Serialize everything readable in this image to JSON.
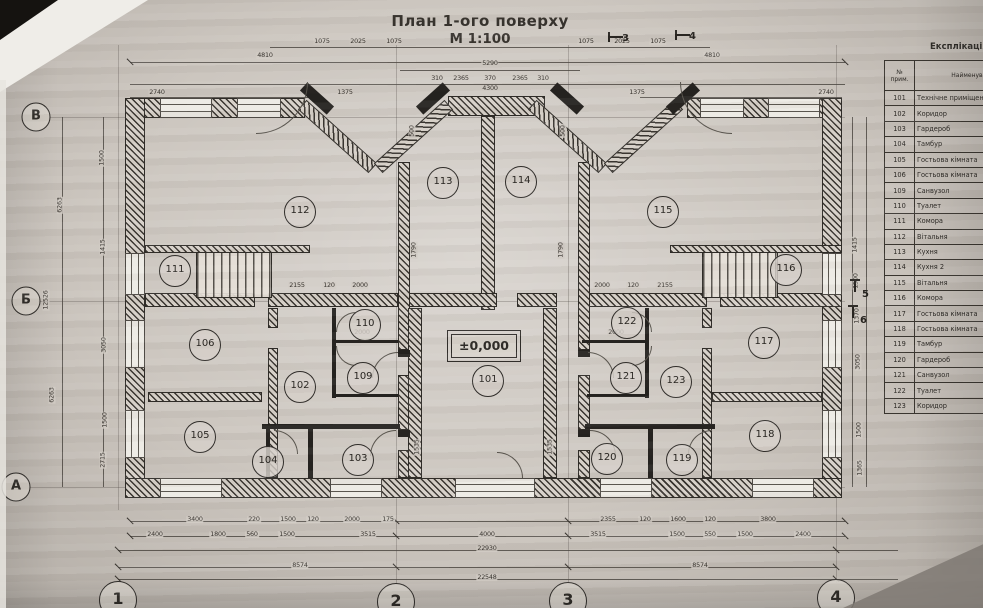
{
  "title": {
    "main": "План 1-ого поверху",
    "scale": "М 1:100"
  },
  "plan": {
    "elevation_mark": "±0,000",
    "axes": {
      "rows": [
        {
          "label": "В",
          "x": 36,
          "y": 117
        },
        {
          "label": "Б",
          "x": 26,
          "y": 301
        },
        {
          "label": "А",
          "x": 16,
          "y": 487
        }
      ],
      "cols": [
        {
          "label": "1",
          "x": 118,
          "y": 600
        },
        {
          "label": "2",
          "x": 396,
          "y": 602
        },
        {
          "label": "3",
          "x": 568,
          "y": 601
        },
        {
          "label": "4",
          "x": 836,
          "y": 598
        }
      ]
    },
    "section_marks": [
      {
        "label": "3",
        "x": 622,
        "y": 33,
        "o": "h"
      },
      {
        "label": "4",
        "x": 689,
        "y": 31,
        "o": "h"
      },
      {
        "label": "5",
        "x": 862,
        "y": 289,
        "o": "v"
      },
      {
        "label": "6",
        "x": 860,
        "y": 315,
        "o": "v"
      }
    ],
    "rooms": [
      {
        "num": "101",
        "x": 488,
        "y": 381
      },
      {
        "num": "102",
        "x": 300,
        "y": 387
      },
      {
        "num": "103",
        "x": 358,
        "y": 460
      },
      {
        "num": "104",
        "x": 268,
        "y": 462
      },
      {
        "num": "105",
        "x": 200,
        "y": 437
      },
      {
        "num": "106",
        "x": 205,
        "y": 345
      },
      {
        "num": "109",
        "x": 363,
        "y": 378
      },
      {
        "num": "110",
        "x": 365,
        "y": 325
      },
      {
        "num": "111",
        "x": 175,
        "y": 271
      },
      {
        "num": "112",
        "x": 300,
        "y": 212
      },
      {
        "num": "113",
        "x": 443,
        "y": 183
      },
      {
        "num": "114",
        "x": 521,
        "y": 182
      },
      {
        "num": "115",
        "x": 663,
        "y": 212
      },
      {
        "num": "116",
        "x": 786,
        "y": 270
      },
      {
        "num": "117",
        "x": 764,
        "y": 343
      },
      {
        "num": "118",
        "x": 765,
        "y": 436
      },
      {
        "num": "119",
        "x": 682,
        "y": 460
      },
      {
        "num": "120",
        "x": 607,
        "y": 459
      },
      {
        "num": "121",
        "x": 626,
        "y": 378
      },
      {
        "num": "122",
        "x": 627,
        "y": 323
      },
      {
        "num": "123",
        "x": 676,
        "y": 382
      }
    ],
    "dimensions": [
      {
        "t": "4810",
        "x": 265,
        "y": 56
      },
      {
        "t": "4810",
        "x": 712,
        "y": 56
      },
      {
        "t": "1075",
        "x": 322,
        "y": 42
      },
      {
        "t": "2025",
        "x": 358,
        "y": 42
      },
      {
        "t": "1075",
        "x": 394,
        "y": 42
      },
      {
        "t": "1075",
        "x": 586,
        "y": 42
      },
      {
        "t": "2025",
        "x": 622,
        "y": 42
      },
      {
        "t": "1075",
        "x": 658,
        "y": 42
      },
      {
        "t": "5290",
        "x": 490,
        "y": 64
      },
      {
        "t": "310",
        "x": 437,
        "y": 79
      },
      {
        "t": "2365",
        "x": 461,
        "y": 79
      },
      {
        "t": "370",
        "x": 490,
        "y": 79
      },
      {
        "t": "2365",
        "x": 520,
        "y": 79
      },
      {
        "t": "310",
        "x": 543,
        "y": 79
      },
      {
        "t": "4300",
        "x": 490,
        "y": 89
      },
      {
        "t": "2740",
        "x": 157,
        "y": 93
      },
      {
        "t": "1375",
        "x": 345,
        "y": 93
      },
      {
        "t": "1375",
        "x": 637,
        "y": 93
      },
      {
        "t": "2740",
        "x": 826,
        "y": 93
      },
      {
        "t": "3400",
        "x": 195,
        "y": 520
      },
      {
        "t": "220",
        "x": 254,
        "y": 520
      },
      {
        "t": "1500",
        "x": 288,
        "y": 520
      },
      {
        "t": "120",
        "x": 313,
        "y": 520
      },
      {
        "t": "2000",
        "x": 352,
        "y": 520
      },
      {
        "t": "175",
        "x": 388,
        "y": 520
      },
      {
        "t": "2355",
        "x": 608,
        "y": 520
      },
      {
        "t": "120",
        "x": 645,
        "y": 520
      },
      {
        "t": "1600",
        "x": 678,
        "y": 520
      },
      {
        "t": "120",
        "x": 710,
        "y": 520
      },
      {
        "t": "3800",
        "x": 768,
        "y": 520
      },
      {
        "t": "2400",
        "x": 155,
        "y": 535
      },
      {
        "t": "1800",
        "x": 218,
        "y": 535
      },
      {
        "t": "560",
        "x": 252,
        "y": 535
      },
      {
        "t": "1500",
        "x": 287,
        "y": 535
      },
      {
        "t": "3515",
        "x": 368,
        "y": 535
      },
      {
        "t": "4000",
        "x": 487,
        "y": 535
      },
      {
        "t": "3515",
        "x": 598,
        "y": 535
      },
      {
        "t": "1500",
        "x": 677,
        "y": 535
      },
      {
        "t": "550",
        "x": 710,
        "y": 535
      },
      {
        "t": "1500",
        "x": 745,
        "y": 535
      },
      {
        "t": "2400",
        "x": 803,
        "y": 535
      },
      {
        "t": "22930",
        "x": 487,
        "y": 549
      },
      {
        "t": "8574",
        "x": 300,
        "y": 566
      },
      {
        "t": "8574",
        "x": 700,
        "y": 566
      },
      {
        "t": "22548",
        "x": 487,
        "y": 578
      },
      {
        "t": "6263",
        "x": 60,
        "y": 205,
        "r": true
      },
      {
        "t": "12526",
        "x": 46,
        "y": 300,
        "r": true
      },
      {
        "t": "6263",
        "x": 52,
        "y": 395,
        "r": true
      },
      {
        "t": "1500",
        "x": 102,
        "y": 158,
        "r": true
      },
      {
        "t": "1415",
        "x": 103,
        "y": 247,
        "r": true
      },
      {
        "t": "3050",
        "x": 104,
        "y": 345,
        "r": true
      },
      {
        "t": "1500",
        "x": 105,
        "y": 420,
        "r": true
      },
      {
        "t": "2715",
        "x": 103,
        "y": 460,
        "r": true
      },
      {
        "t": "1415",
        "x": 855,
        "y": 245,
        "r": true
      },
      {
        "t": "1500",
        "x": 856,
        "y": 281,
        "r": true
      },
      {
        "t": "1370",
        "x": 857,
        "y": 316,
        "r": true
      },
      {
        "t": "3050",
        "x": 858,
        "y": 362,
        "r": true
      },
      {
        "t": "1500",
        "x": 859,
        "y": 430,
        "r": true
      },
      {
        "t": "1365",
        "x": 860,
        "y": 468,
        "r": true
      },
      {
        "t": "2155",
        "x": 297,
        "y": 286
      },
      {
        "t": "120",
        "x": 329,
        "y": 286
      },
      {
        "t": "2000",
        "x": 360,
        "y": 286
      },
      {
        "t": "2000",
        "x": 602,
        "y": 286
      },
      {
        "t": "120",
        "x": 633,
        "y": 286
      },
      {
        "t": "2155",
        "x": 665,
        "y": 286
      },
      {
        "t": "1790",
        "x": 414,
        "y": 250,
        "r": true
      },
      {
        "t": "1790",
        "x": 561,
        "y": 250,
        "r": true
      },
      {
        "t": "500",
        "x": 412,
        "y": 131,
        "r": true
      },
      {
        "t": "500",
        "x": 563,
        "y": 131,
        "r": true
      },
      {
        "t": "1535",
        "x": 417,
        "y": 447,
        "r": true
      },
      {
        "t": "1535",
        "x": 550,
        "y": 447,
        "r": true
      },
      {
        "t": "2000",
        "x": 362,
        "y": 333
      },
      {
        "t": "2000",
        "x": 616,
        "y": 333
      }
    ]
  },
  "explication": {
    "title": "Експлікація приміщень",
    "col_num": "№\nприм.",
    "col_name": "Найменування",
    "rows": [
      {
        "num": "101",
        "name": "Технічне приміщення"
      },
      {
        "num": "102",
        "name": "Коридор"
      },
      {
        "num": "103",
        "name": "Гардероб"
      },
      {
        "num": "104",
        "name": "Тамбур"
      },
      {
        "num": "105",
        "name": "Гостьова кімната"
      },
      {
        "num": "106",
        "name": "Гостьова кімната"
      },
      {
        "num": "109",
        "name": "Санвузол"
      },
      {
        "num": "110",
        "name": "Туалет"
      },
      {
        "num": "111",
        "name": "Комора"
      },
      {
        "num": "112",
        "name": "Вітальня"
      },
      {
        "num": "113",
        "name": "Кухня"
      },
      {
        "num": "114",
        "name": "Кухня 2"
      },
      {
        "num": "115",
        "name": "Вітальня"
      },
      {
        "num": "116",
        "name": "Комора"
      },
      {
        "num": "117",
        "name": "Гостьова кімната"
      },
      {
        "num": "118",
        "name": "Гостьова кімната"
      },
      {
        "num": "119",
        "name": "Тамбур"
      },
      {
        "num": "120",
        "name": "Гардероб"
      },
      {
        "num": "121",
        "name": "Санвузол"
      },
      {
        "num": "122",
        "name": "Туалет"
      },
      {
        "num": "123",
        "name": "Коридор"
      }
    ]
  },
  "colors": {
    "paper": "#ccc6bf",
    "ink": "#2f2c28",
    "wall_fill": "#38342f"
  }
}
